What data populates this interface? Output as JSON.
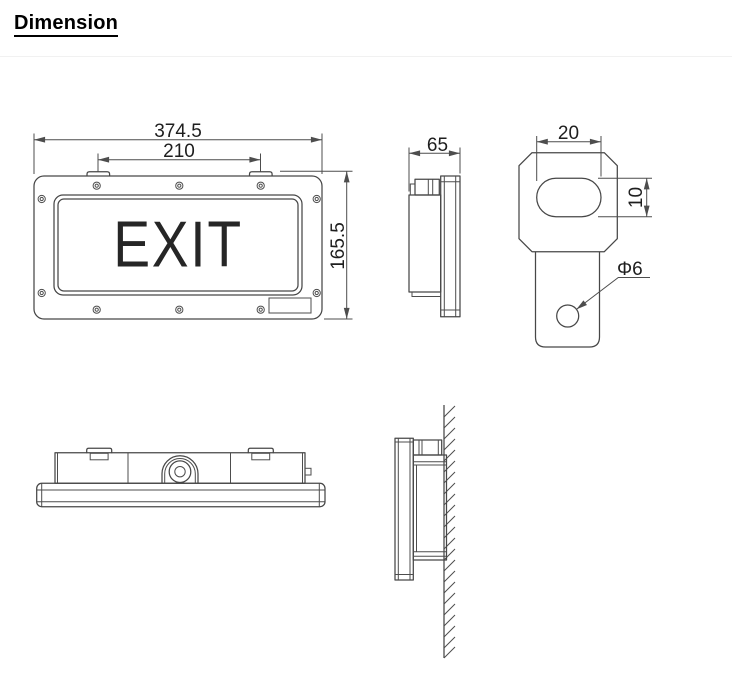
{
  "page": {
    "title": "Dimension",
    "background": "#ffffff",
    "line_color": "#474747",
    "text_color": "#1e1e1e"
  },
  "front_view": {
    "name": "front view of exit sign luminaire",
    "sign_text": "EXIT",
    "dim_overall_width": "374.5",
    "dim_mount_spacing": "210",
    "dim_overall_height": "165.5"
  },
  "side_view": {
    "name": "side view",
    "dim_depth": "65"
  },
  "bracket_view": {
    "name": "mounting bracket",
    "dim_slot_width": "20",
    "dim_slot_height": "10",
    "dim_hole_diameter": "Φ6"
  },
  "top_view": {
    "name": "top view of luminaire body"
  },
  "wall_view": {
    "name": "wall mounted side view"
  }
}
